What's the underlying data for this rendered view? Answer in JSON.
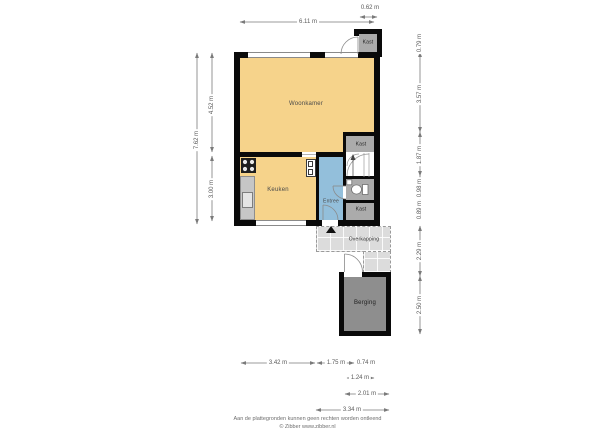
{
  "rooms": {
    "woonkamer": "Woonkamer",
    "keuken": "Keuken",
    "entree": "Entree",
    "kast_top": "Kast",
    "kast_mid": "Kast",
    "kast_bottom": "Kast",
    "overkapping": "Overkapping",
    "berging": "Berging"
  },
  "dimensions": {
    "top_width": "6.11 m",
    "top_kast": "0.62 m",
    "left_total": "7.62 m",
    "left_upper": "4.52 m",
    "left_lower": "3.00 m",
    "right": [
      "0.79 m",
      "3.57 m",
      "1.87 m",
      "0.98 m",
      "0.89 m",
      "2.29 m",
      "2.50 m"
    ],
    "bottom_row1": [
      "3.42 m",
      "1.75 m",
      "0.74 m"
    ],
    "bottom_row2": "1.24 m",
    "bottom_row3": "2.01 m",
    "bottom_row4": "3.34 m"
  },
  "footer": {
    "line1": "Aan de plattegronden kunnen geen rechten worden ontleend",
    "line2": "© Zibber www.zibber.nl"
  },
  "colors": {
    "wall": "#0a0a0a",
    "living": "#f6d38b",
    "entry": "#93bfdb",
    "closet": "#ababab",
    "storage": "#8e8e8e",
    "canopy": "#dcdcdc"
  },
  "icons": [
    "stove-icon",
    "sink-icon",
    "toilet-icon",
    "stairs-up-arrow-icon",
    "entrance-marker-icon",
    "door-arc"
  ]
}
